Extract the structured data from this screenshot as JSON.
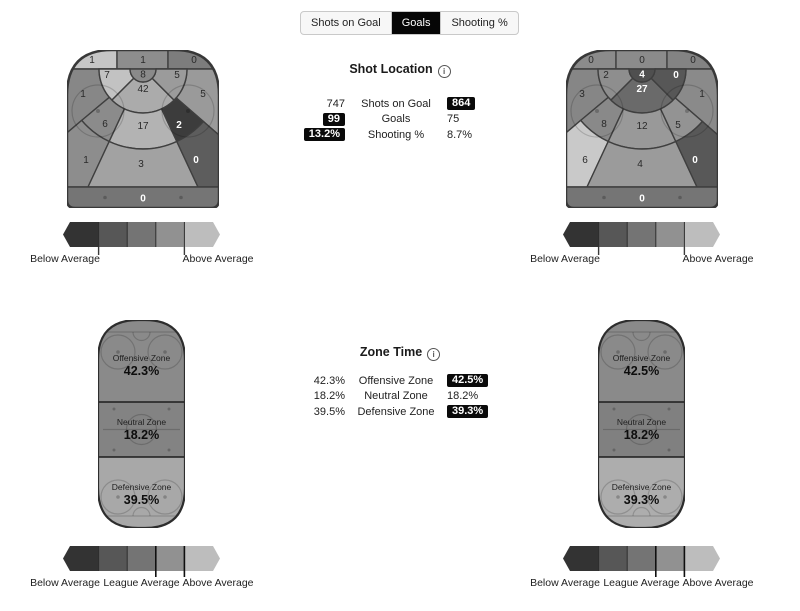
{
  "tabs": {
    "items": [
      "Shots on Goal",
      "Goals",
      "Shooting %"
    ],
    "active": "Goals"
  },
  "shot_location": {
    "title": "Shot Location",
    "rows": [
      {
        "left": "747",
        "label": "Shots on Goal",
        "right": "864"
      },
      {
        "left": "99",
        "label": "Goals",
        "right": "75"
      },
      {
        "left": "13.2%",
        "label": "Shooting %",
        "right": "8.7%"
      }
    ]
  },
  "zone_time": {
    "title": "Zone Time",
    "rows": [
      {
        "left": "42.3%",
        "label": "Offensive Zone",
        "right": "42.5%"
      },
      {
        "left": "18.2%",
        "label": "Neutral Zone",
        "right": "18.2%"
      },
      {
        "left": "39.5%",
        "label": "Defensive Zone",
        "right": "39.3%"
      }
    ]
  },
  "shot_rinks": {
    "left": {
      "values": {
        "corner_l": "1",
        "corner_c": "1",
        "corner_r": "0",
        "wing_l": "7",
        "crease": "8",
        "slot": "42",
        "wing_r": "5",
        "side_l": "1",
        "side_r": "5",
        "mid_l": "6",
        "mid_c": "17",
        "mid_r": "2",
        "low_l": "1",
        "low_c": "3",
        "low_r": "0",
        "boards": "0"
      },
      "fills": {
        "corner_l": "#c6c6c6",
        "corner_c": "#8d8d8d",
        "corner_r": "#7d7d7d",
        "wing_l": "#c2c2c2",
        "crease": "#8a8a8a",
        "slot": "#ababab",
        "wing_r": "#9b9b9b",
        "side_l": "#878787",
        "side_r": "#9a9a9a",
        "mid_l": "#8b8b8b",
        "mid_c": "#b3b3b3",
        "mid_r": "#3c3c3c",
        "low_l": "#8d8d8d",
        "low_c": "#a2a2a2",
        "low_r": "#5d5d5d",
        "boards": "#757575"
      }
    },
    "right": {
      "values": {
        "corner_l": "0",
        "corner_c": "0",
        "corner_r": "0",
        "wing_l": "2",
        "crease": "4",
        "slot": "27",
        "wing_r": "0",
        "side_l": "3",
        "side_r": "1",
        "mid_l": "8",
        "mid_c": "12",
        "mid_r": "5",
        "low_l": "6",
        "low_c": "4",
        "low_r": "0",
        "boards": "0"
      },
      "fills": {
        "corner_l": "#8b8b8b",
        "corner_c": "#8b8b8b",
        "corner_r": "#838383",
        "wing_l": "#8e8e8e",
        "crease": "#4f4f4f",
        "slot": "#6a6a6a",
        "wing_r": "#575757",
        "side_l": "#868686",
        "side_r": "#8a8a8a",
        "mid_l": "#898989",
        "mid_c": "#999999",
        "mid_r": "#939393",
        "low_l": "#c9c9c9",
        "low_c": "#9b9b9b",
        "low_r": "#585858",
        "boards": "#757575"
      }
    }
  },
  "zone_rinks": {
    "left": {
      "zones": [
        {
          "label": "Offensive Zone",
          "value": "42.3%",
          "fill": "#8a8a8a"
        },
        {
          "label": "Neutral Zone",
          "value": "18.2%",
          "fill": "#838383"
        },
        {
          "label": "Defensive Zone",
          "value": "39.5%",
          "fill": "#a8a8a8"
        }
      ]
    },
    "right": {
      "zones": [
        {
          "label": "Offensive Zone",
          "value": "42.5%",
          "fill": "#8a8a8a"
        },
        {
          "label": "Neutral Zone",
          "value": "18.2%",
          "fill": "#808080"
        },
        {
          "label": "Defensive Zone",
          "value": "39.3%",
          "fill": "#adadad"
        }
      ]
    }
  },
  "legend": {
    "colors": [
      "#333333",
      "#575757",
      "#747474",
      "#919191",
      "#bdbdbd"
    ],
    "shot_labels": {
      "left": "Below Average",
      "right": "Above Average"
    },
    "zone_labels": {
      "left": "Below Average",
      "center": "League Average",
      "right": "Above Average"
    }
  }
}
